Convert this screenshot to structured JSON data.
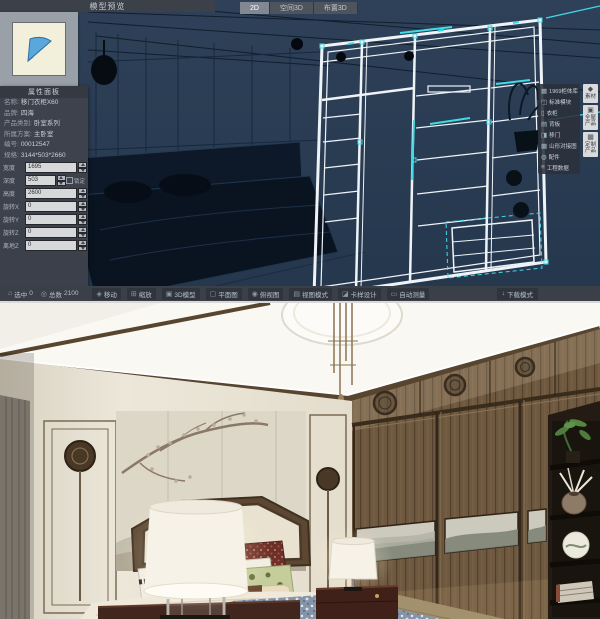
{
  "window": {
    "preview_panel_title": "模型预览"
  },
  "view_tabs": {
    "items": [
      {
        "label": "2D",
        "active": true
      },
      {
        "label": "空间3D",
        "active": false
      },
      {
        "label": "布置3D",
        "active": false
      }
    ]
  },
  "properties": {
    "title": "属性面板",
    "info_rows": [
      {
        "label": "名称:",
        "value": "移门衣柜X60"
      },
      {
        "label": "品牌:",
        "value": "四海"
      },
      {
        "label": "产品类别:",
        "value": "卧室系列"
      },
      {
        "label": "所属方案:",
        "value": "主卧室"
      },
      {
        "label": "编号:",
        "value": "00012547"
      },
      {
        "label": "规格:",
        "value": "3144*503*2660"
      }
    ],
    "fields": [
      {
        "label": "宽度",
        "value": "1695"
      },
      {
        "label": "深度",
        "value": "503",
        "checkbox": "锁定"
      },
      {
        "label": "高度",
        "value": "2600"
      },
      {
        "label": "旋转X",
        "value": "0"
      },
      {
        "label": "旋转Y",
        "value": "0"
      },
      {
        "label": "旋转Z",
        "value": "0"
      },
      {
        "label": "离地Z",
        "value": "0"
      }
    ]
  },
  "right_menu": {
    "items": [
      {
        "icon": "▦",
        "label": "1969柜体库"
      },
      {
        "icon": "◫",
        "label": "标准模块"
      },
      {
        "icon": "▯",
        "label": "衣柜"
      },
      {
        "icon": "▤",
        "label": "背板"
      },
      {
        "icon": "◨",
        "label": "移门"
      },
      {
        "icon": "▩",
        "label": "山形对接图"
      },
      {
        "icon": "◍",
        "label": "配件"
      },
      {
        "icon": "≡",
        "label": "工程数据"
      }
    ]
  },
  "dock": {
    "items": [
      {
        "icon": "◆",
        "label": "素材"
      },
      {
        "icon": "▣",
        "label": "全屋产品"
      },
      {
        "icon": "▦",
        "label": "定制产品"
      }
    ]
  },
  "status_bar": {
    "selected": {
      "icon": "⌂",
      "label": "选中",
      "value": "0"
    },
    "total": {
      "icon": "◎",
      "label": "总数",
      "value": "2100"
    },
    "tools": [
      {
        "icon": "◈",
        "label": "移动"
      },
      {
        "icon": "⊞",
        "label": "缩放"
      },
      {
        "icon": "▣",
        "label": "3D模型"
      },
      {
        "icon": "▢",
        "label": "平面图"
      },
      {
        "icon": "◉",
        "label": "俯视图"
      },
      {
        "icon": "▤",
        "label": "视图模式"
      },
      {
        "icon": "◪",
        "label": "卡样设计"
      },
      {
        "icon": "▭",
        "label": "自动测量"
      }
    ],
    "download": {
      "icon": "↓",
      "label": "下载模式"
    }
  },
  "colors": {
    "accent_cyan": "#3FDCE6",
    "viewport_bg": "#2C3F57",
    "panel_bg": "#3E434C",
    "wireframe_white": "#EEF3F8",
    "wood_brown": "#6E583F",
    "wall_cream": "#E8E3D5",
    "nightstand_red": "#40261D"
  }
}
